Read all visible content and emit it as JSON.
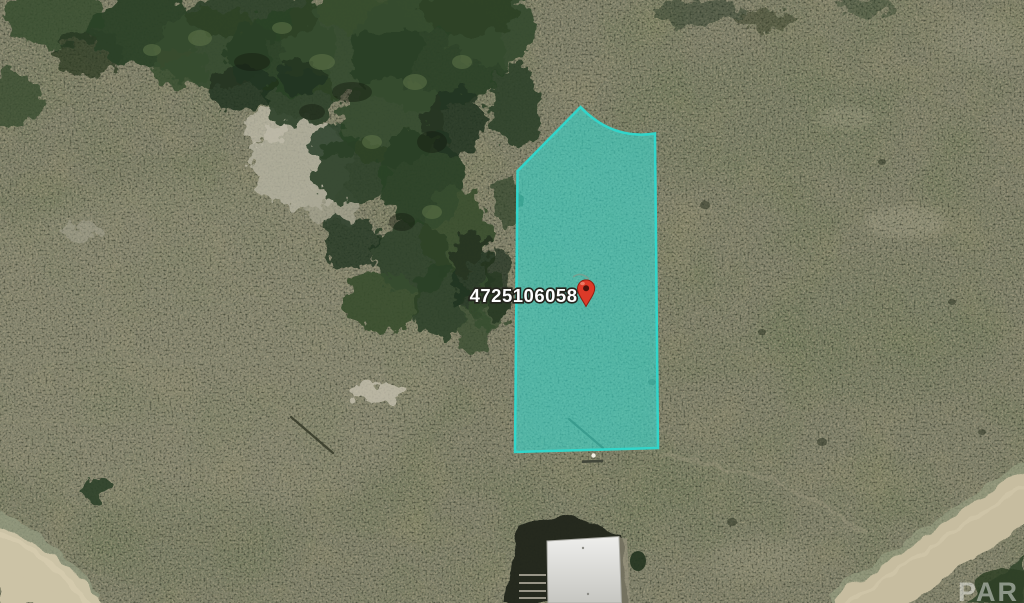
{
  "parcel": {
    "id": "4725106058",
    "fill_color": "#38d5ca",
    "fill_opacity": "0.62",
    "outline_color": "#2fd8cd"
  },
  "pin": {
    "icon": "red-map-pin",
    "body_color": "#dc3a28",
    "hole_color": "#4a120b"
  },
  "watermark": {
    "text": "PAR"
  }
}
